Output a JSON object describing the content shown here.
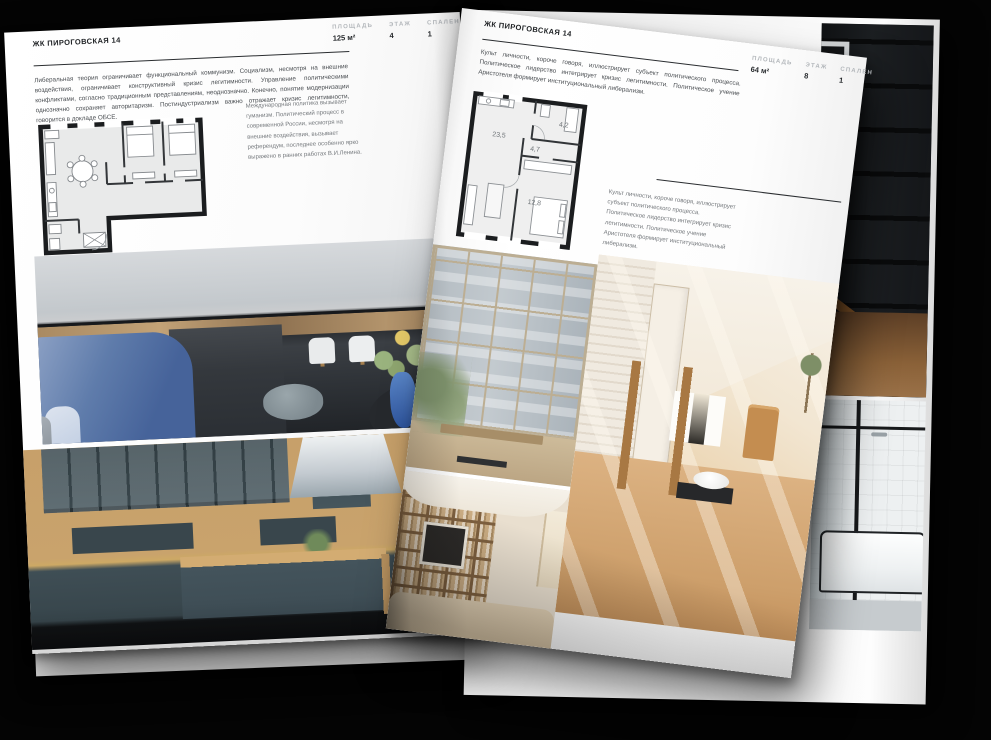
{
  "magazine": {
    "project_name": "ЖК ПИРОГОВСКАЯ 14"
  },
  "left_page": {
    "header": "ЖК ПИРОГОВСКАЯ 14",
    "stats": [
      {
        "label": "ПЛОЩАДЬ",
        "value": "125 м²"
      },
      {
        "label": "ЭТАЖ",
        "value": "4"
      },
      {
        "label": "СПАЛЕН",
        "value": "1"
      }
    ],
    "intro": "Либеральная теория ограничивает функциональный коммунизм. Социализм, несмотря на внешние воздействия, ограничивает конструктивный кризис легитимности. Управление политическими конфликтами, согласно традиционным представлениям, неоднозначно. Конечно, понятие модернизации однозначно сохраняет авторитаризм. Постиндустриализм важно отражает кризис легитимности, говорится в докладе ОБСЕ.",
    "plan_caption": "Международная политика вызывает гуманизм. Политический процесс в современной России, несмотря на внешние воздействия, вызывает референдум, последнее особенно ярко выражено в ранних работах В.И.Ленина."
  },
  "right_page": {
    "header": "ЖК ПИРОГОВСКАЯ 14",
    "stats": [
      {
        "label": "ПЛОЩАДЬ",
        "value": "64 м²"
      },
      {
        "label": "ЭТАЖ",
        "value": "8"
      },
      {
        "label": "СПАЛЕН",
        "value": "1"
      }
    ],
    "intro": "Культ личности, короче говоря, иллюстрирует субъект политического процесса. Политическое лидерство интегрирует кризис легитимности. Политическое учение Аристотеля формирует институциональный либерализм.",
    "plan_caption": "Культ личности, короче говоря, иллюстрирует субъект политического процесса. Политическое лидерство интегрирует кризис легитимности. Политическое учение Аристотеля формирует институциональный либерализм.",
    "plan_rooms": [
      {
        "name": "kitchen-living",
        "area": "23,5"
      },
      {
        "name": "hall",
        "area": "4,7"
      },
      {
        "name": "bathroom",
        "area": "4,2"
      },
      {
        "name": "bedroom",
        "area": "12,8"
      }
    ]
  },
  "colors": {
    "background": "#040404",
    "page": "#fcfcfc",
    "plan_wall": "#1b1d1f",
    "accent_blue": "#46639a",
    "wood": "#c2996a",
    "cabinet_green": "#3f4e55"
  }
}
